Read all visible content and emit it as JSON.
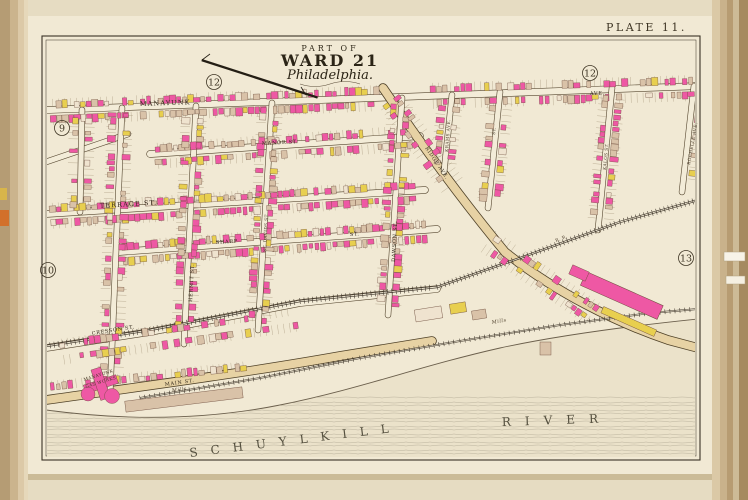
{
  "page": {
    "plate_label": "PLATE 11."
  },
  "title": {
    "line1": "PART OF",
    "line2": "WARD 21",
    "line3": "Philadelphia."
  },
  "adjacent_plates": {
    "west": "9",
    "north_west": "12",
    "north_east": "12",
    "south_west": "10",
    "east": "13"
  },
  "river": {
    "word1": "SCHUYLKILL",
    "word2": "RIVER"
  },
  "streets": {
    "manayunk": "MANAYUNK",
    "ave_suffix": "AVE.",
    "manor": "MANOR ST.",
    "terrace": "TERRACE ST.",
    "sharp": "SHARP",
    "sharp_suffix": "ST.",
    "cresson": "CRESSON ST.",
    "main": "MAIN ST.",
    "ridge": "RIDGE AVE.",
    "hermit": "HERMIT ST.",
    "st_davids": "ST. DAVIDS ST.",
    "dawson": "DAWSON ST.",
    "krams": "KRAMS AVE.",
    "short_st": "ST.",
    "kalos": "KALOS ST.",
    "rochelle": "ROCHELLE AVE."
  },
  "landmarks": {
    "gas_works_line1": "MANAYUNK",
    "gas_works_line2": "GAS WORKS",
    "mills_left": "Mills",
    "mills_right": "Mills",
    "railroad": "R. R."
  }
}
